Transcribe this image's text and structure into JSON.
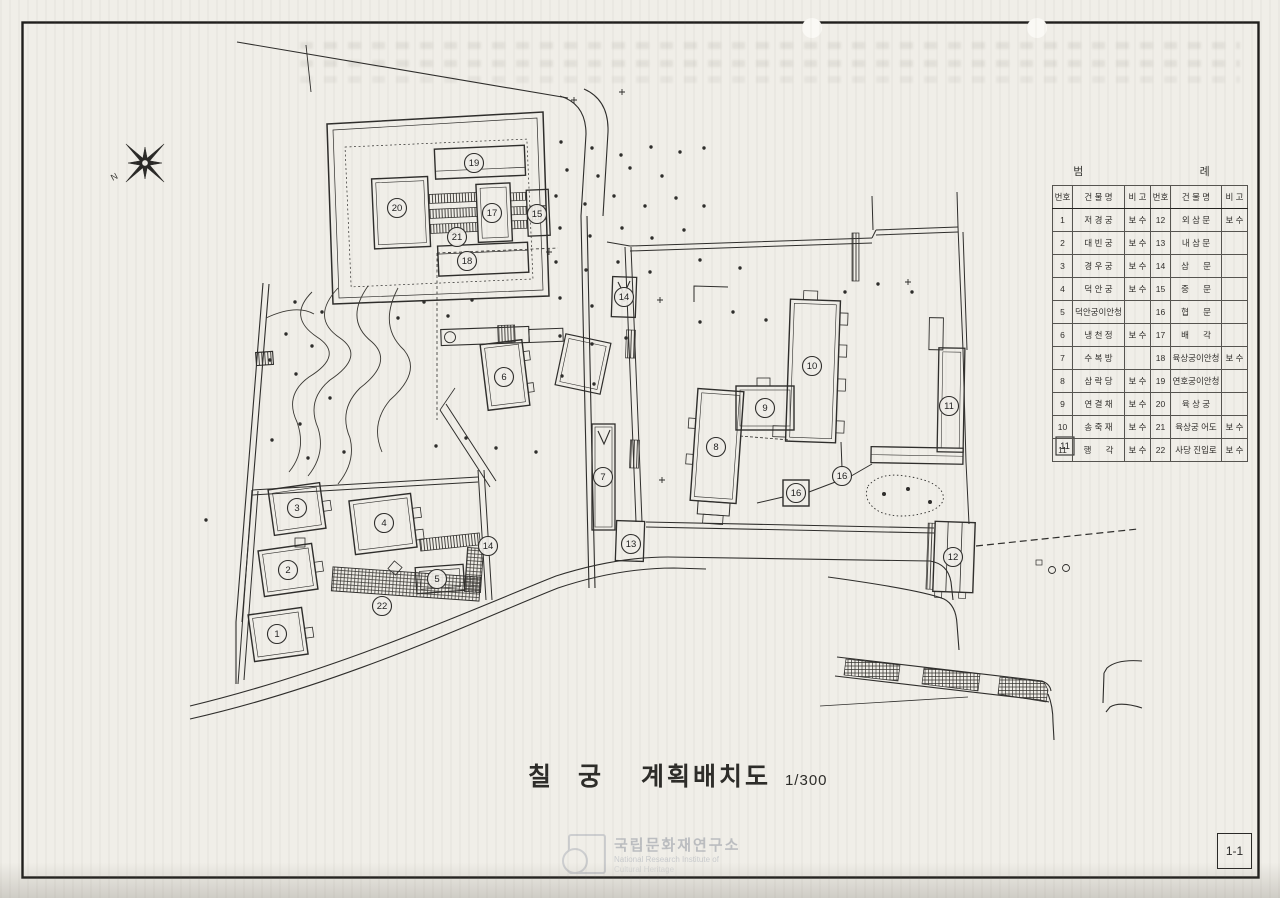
{
  "sheet": {
    "page_label": "1-1"
  },
  "compass": {
    "icon": "compass-star",
    "mark": "N"
  },
  "title_block": {
    "site_name": "칠 궁",
    "drawing_name": "계획배치도",
    "scale": "1/300"
  },
  "legend": {
    "title": "범      례",
    "headers": {
      "no": "번호",
      "name": "건 물 명",
      "remark": "비 고"
    },
    "entries": [
      {
        "no": "1",
        "name": "저 경 궁",
        "remark": "보 수"
      },
      {
        "no": "2",
        "name": "대 빈 궁",
        "remark": "보 수"
      },
      {
        "no": "3",
        "name": "경 우 궁",
        "remark": "보 수"
      },
      {
        "no": "4",
        "name": "덕 안 궁",
        "remark": "보 수"
      },
      {
        "no": "5",
        "name": "덕안궁이안청",
        "remark": ""
      },
      {
        "no": "6",
        "name": "냉 천 정",
        "remark": "보 수"
      },
      {
        "no": "7",
        "name": "수 복 방",
        "remark": ""
      },
      {
        "no": "8",
        "name": "삼 락 당",
        "remark": "보 수"
      },
      {
        "no": "9",
        "name": "연 결 채",
        "remark": "보 수"
      },
      {
        "no": "10",
        "name": "송 죽 재",
        "remark": "보 수"
      },
      {
        "no": "11",
        "name": "행      각",
        "remark": "보 수"
      },
      {
        "no": "12",
        "name": "외 삼 문",
        "remark": "보 수"
      },
      {
        "no": "13",
        "name": "내 삼 문",
        "remark": ""
      },
      {
        "no": "14",
        "name": "삼      문",
        "remark": ""
      },
      {
        "no": "15",
        "name": "중      문",
        "remark": ""
      },
      {
        "no": "16",
        "name": "협      문",
        "remark": ""
      },
      {
        "no": "17",
        "name": "배      각",
        "remark": ""
      },
      {
        "no": "18",
        "name": "육상궁이안청",
        "remark": "보 수"
      },
      {
        "no": "19",
        "name": "연호궁이안청",
        "remark": ""
      },
      {
        "no": "20",
        "name": "육 상 궁",
        "remark": ""
      },
      {
        "no": "21",
        "name": "육상궁 어도",
        "remark": "보 수"
      },
      {
        "no": "22",
        "name": "사당 진입로",
        "remark": "보 수"
      }
    ]
  },
  "watermark": {
    "org_kr": "국립문화재연구소",
    "org_en_line1": "National Research Institute of",
    "org_en_line2": "Cultural Heritage"
  },
  "plan": {
    "colors": {
      "line": "#2e2d2b",
      "paper": "#f0eee8"
    },
    "markers": [
      {
        "no": "1",
        "x": 277,
        "y": 634,
        "shape": "circle"
      },
      {
        "no": "2",
        "x": 288,
        "y": 570,
        "shape": "circle"
      },
      {
        "no": "3",
        "x": 297,
        "y": 508,
        "shape": "circle"
      },
      {
        "no": "4",
        "x": 384,
        "y": 523,
        "shape": "circle"
      },
      {
        "no": "5",
        "x": 437,
        "y": 579,
        "shape": "circle"
      },
      {
        "no": "6",
        "x": 504,
        "y": 377,
        "shape": "circle"
      },
      {
        "no": "7",
        "x": 603,
        "y": 477,
        "shape": "circle"
      },
      {
        "no": "8",
        "x": 716,
        "y": 447,
        "shape": "circle"
      },
      {
        "no": "9",
        "x": 765,
        "y": 408,
        "shape": "circle"
      },
      {
        "no": "10",
        "x": 812,
        "y": 366,
        "shape": "circle"
      },
      {
        "no": "11",
        "x": 949,
        "y": 406,
        "shape": "circle"
      },
      {
        "no": "11",
        "x": 1065,
        "y": 446,
        "shape": "box"
      },
      {
        "no": "12",
        "x": 953,
        "y": 557,
        "shape": "circle"
      },
      {
        "no": "13",
        "x": 631,
        "y": 544,
        "shape": "circle"
      },
      {
        "no": "14",
        "x": 624,
        "y": 297,
        "shape": "circle"
      },
      {
        "no": "14",
        "x": 488,
        "y": 546,
        "shape": "circle"
      },
      {
        "no": "15",
        "x": 537,
        "y": 214,
        "shape": "circle"
      },
      {
        "no": "16",
        "x": 796,
        "y": 493,
        "shape": "circle"
      },
      {
        "no": "16",
        "x": 842,
        "y": 476,
        "shape": "circle"
      },
      {
        "no": "17",
        "x": 492,
        "y": 213,
        "shape": "circle"
      },
      {
        "no": "18",
        "x": 467,
        "y": 261,
        "shape": "circle"
      },
      {
        "no": "19",
        "x": 474,
        "y": 163,
        "shape": "circle"
      },
      {
        "no": "20",
        "x": 397,
        "y": 208,
        "shape": "circle"
      },
      {
        "no": "21",
        "x": 457,
        "y": 237,
        "shape": "circle"
      },
      {
        "no": "22",
        "x": 382,
        "y": 606,
        "shape": "circle"
      }
    ],
    "tree_dots": [
      [
        561,
        142
      ],
      [
        592,
        148
      ],
      [
        621,
        155
      ],
      [
        651,
        147
      ],
      [
        680,
        152
      ],
      [
        704,
        148
      ],
      [
        567,
        170
      ],
      [
        598,
        176
      ],
      [
        630,
        168
      ],
      [
        662,
        176
      ],
      [
        556,
        196
      ],
      [
        585,
        204
      ],
      [
        614,
        196
      ],
      [
        645,
        206
      ],
      [
        676,
        198
      ],
      [
        704,
        206
      ],
      [
        560,
        228
      ],
      [
        590,
        236
      ],
      [
        622,
        228
      ],
      [
        652,
        238
      ],
      [
        684,
        230
      ],
      [
        556,
        262
      ],
      [
        586,
        270
      ],
      [
        618,
        262
      ],
      [
        650,
        272
      ],
      [
        560,
        298
      ],
      [
        592,
        306
      ],
      [
        624,
        300
      ],
      [
        560,
        336
      ],
      [
        592,
        344
      ],
      [
        626,
        338
      ],
      [
        562,
        376
      ],
      [
        594,
        384
      ],
      [
        472,
        300
      ],
      [
        448,
        316
      ],
      [
        424,
        302
      ],
      [
        398,
        318
      ],
      [
        295,
        302
      ],
      [
        322,
        312
      ],
      [
        286,
        334
      ],
      [
        312,
        346
      ],
      [
        270,
        360
      ],
      [
        296,
        374
      ],
      [
        330,
        398
      ],
      [
        300,
        424
      ],
      [
        272,
        440
      ],
      [
        308,
        458
      ],
      [
        344,
        452
      ],
      [
        436,
        446
      ],
      [
        466,
        438
      ],
      [
        496,
        448
      ],
      [
        700,
        322
      ],
      [
        733,
        312
      ],
      [
        766,
        320
      ],
      [
        845,
        292
      ],
      [
        878,
        284
      ],
      [
        912,
        292
      ],
      [
        700,
        260
      ],
      [
        740,
        268
      ],
      [
        536,
        452
      ],
      [
        206,
        520
      ]
    ],
    "cross_marks": [
      [
        549,
        252
      ],
      [
        908,
        282
      ],
      [
        622,
        92
      ],
      [
        662,
        480
      ],
      [
        574,
        100
      ],
      [
        660,
        300
      ]
    ]
  }
}
